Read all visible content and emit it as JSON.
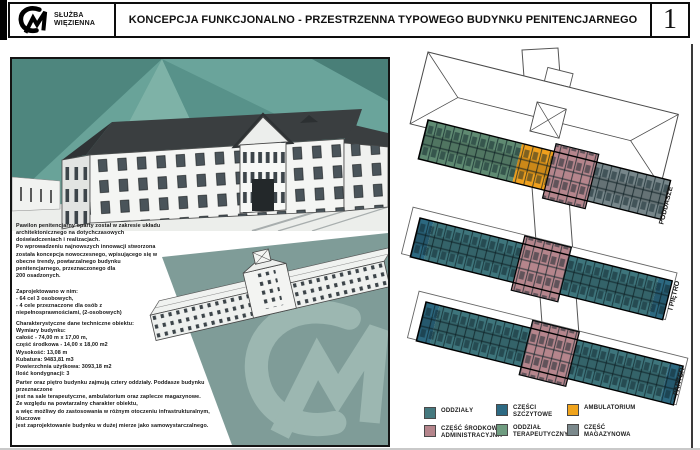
{
  "header": {
    "agency_line1": "SŁUŻBA",
    "agency_line2": "WIĘZIENNA",
    "title": "KONCEPCJA FUNKCJONALNO - PRZESTRZENNA TYPOWEGO BUDYNKU PENITENCJARNEGO",
    "page_number": "1"
  },
  "left_panel": {
    "paragraph_intro": "Pawilon penitencjarny oparty został w zakresie układu\narchitektonicznego na dotychczasowych\ndoświadczeniach i realizacjach.\nPo wprowadzeniu najnowszych innowacji stworzona\nzostała koncepcja nowoczesnego, wpisującego się w\nobecne trendy, powtarzalnego budynku\npenitencjarnego, przeznaczonego dla\n200 osadzonych.",
    "paragraph_program": "Zaprojektowano w nim:\n- 64 cel 3 osobowych,\n- 4 cele przeznaczone dla osób z\nniepełnosprawnościami, (2-osobowych)",
    "paragraph_tech": "Charakterystyczne dane techniczne obiektu:\nWymiary budynku:\ncałość - 74,00 m x 17,00 m,\nczęść środkowa - 14,00 x 18,00 m2\nWysokość: 13,08 m\nKubatura: 9483,81 m3\nPowierzchnia użytkowa: 3093,18 m2\nIlość kondygnacji: 3",
    "paragraph_floors": "Parter oraz piętro budynku zajmują cztery oddziały. Poddasze budynku przeznaczone\njest na sale terapeutyczne, ambulatorium oraz zaplecze magazynowe.\nZe względu na powtarzalny charakter obiektu,\na więc możliwy do zastosowania w różnym otoczeniu infrastrukturalnym, kluczowe\njest zaprojektowanie budynku w dużej mierze jako samowystarczalnego."
  },
  "right_panel": {
    "floor_labels": [
      "PODDASZE",
      "I PIĘTRO",
      "PARTER"
    ],
    "legend": {
      "items": [
        {
          "label": "ODDZIAŁY",
          "color": "#45797f"
        },
        {
          "label": "CZĘŚĆ ŚRODKOWA\nADMINISTRACYJNA",
          "color": "#b5858c"
        },
        {
          "label": "CZĘŚCI\nSZCZYTOWE",
          "color": "#2d6a83"
        },
        {
          "label": "ODDZIAŁ\nTERAPEUTYCZNY",
          "color": "#6f9c80"
        },
        {
          "label": "AMBULATORIUM",
          "color": "#f0a41d"
        },
        {
          "label": "CZĘŚĆ\nMAGAZYNOWA",
          "color": "#7b898c"
        }
      ]
    }
  },
  "colors": {
    "units_teal": "#3e757c",
    "admin_rose": "#b5858c",
    "gable_blue": "#2c6880",
    "therapy_green": "#5f8a72",
    "ambulatory_orange": "#efa01d",
    "storage_gray": "#77868a",
    "backdrop_teal": "#5c968c",
    "watermark_teal": "#9cb7b1"
  }
}
